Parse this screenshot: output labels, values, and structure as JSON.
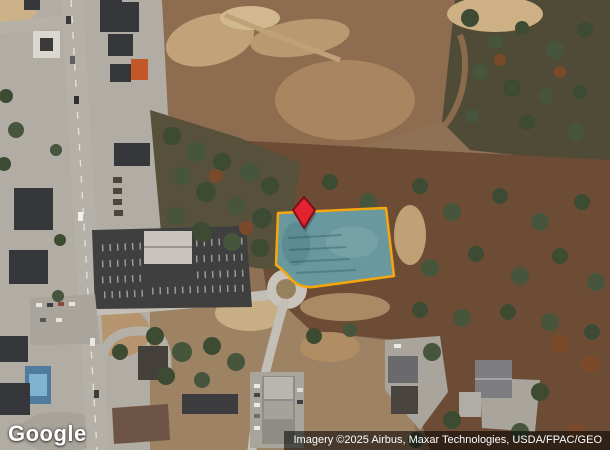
{
  "map": {
    "type": "satellite",
    "logo": "Google",
    "attribution": "Imagery ©2025 Airbus, Maxar Technologies, USDA/FPAC/GEO",
    "colors": {
      "parcel_fill": "rgba(64,148,164,0.52)",
      "parcel_underlay": "#97a09a",
      "parcel_stroke": "#F6A70B",
      "pin_fill": "#E32330",
      "pin_stroke": "#7E0E16",
      "attribution_bg": "rgba(0,0,0,0.55)",
      "attribution_color": "#FFFFFF",
      "logo_color": "#FFFFFF"
    }
  }
}
